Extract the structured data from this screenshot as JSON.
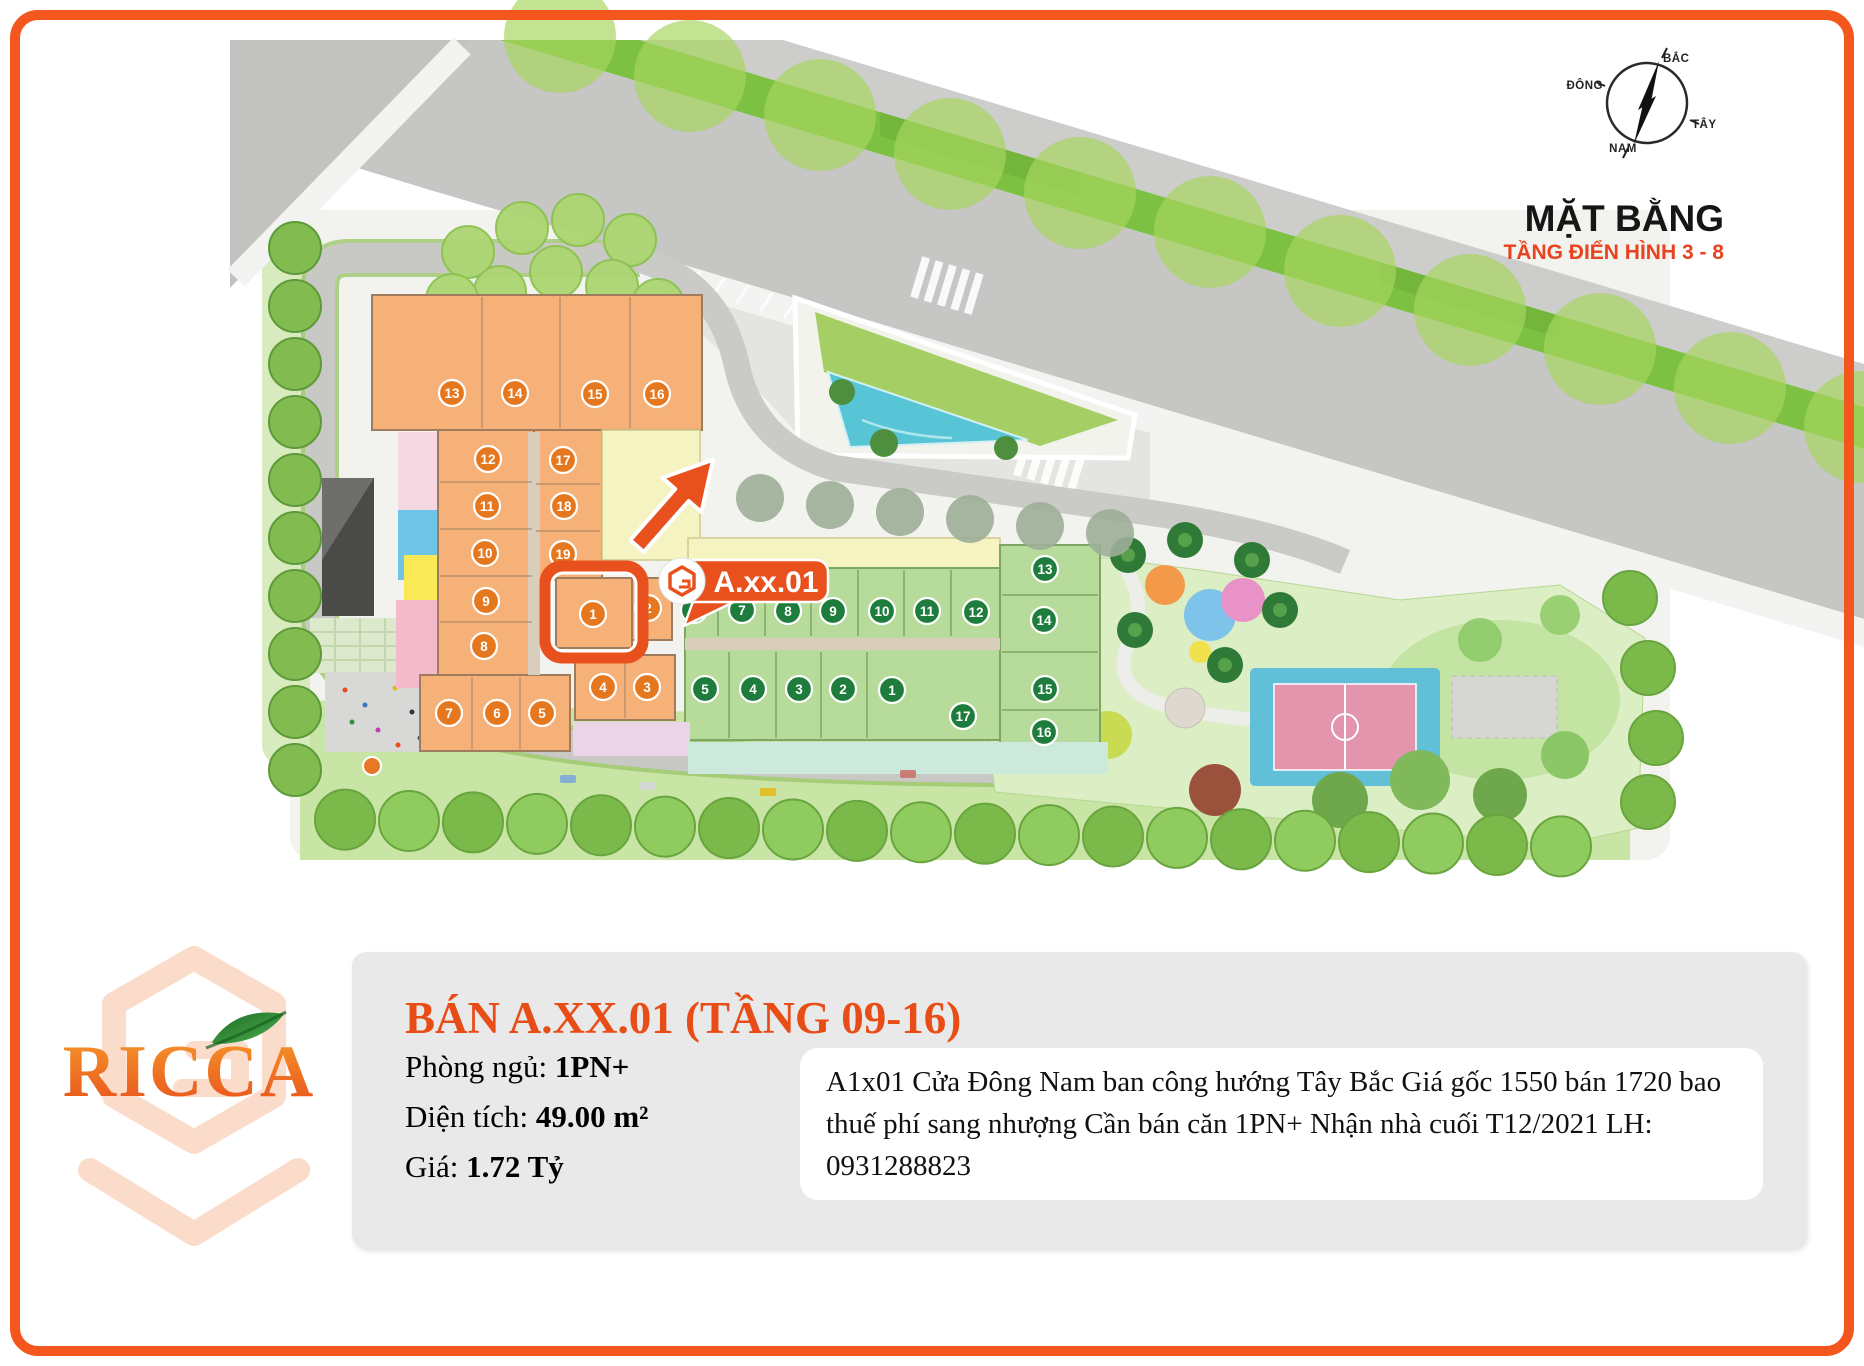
{
  "site_plan": {
    "heading": {
      "title": "MẶT BẰNG",
      "subtitle": "TẦNG ĐIỂN HÌNH 3 - 8"
    },
    "compass": {
      "north": "BẮC",
      "east": "ĐÔNG",
      "west": "TÂY",
      "south": "NAM"
    },
    "unit_label": {
      "text": "A.xx.01"
    },
    "highlighted_unit": "1",
    "blocks": {
      "orange_units": [
        {
          "n": "13",
          "x": 452,
          "y": 393
        },
        {
          "n": "14",
          "x": 515,
          "y": 393
        },
        {
          "n": "15",
          "x": 595,
          "y": 394
        },
        {
          "n": "16",
          "x": 657,
          "y": 394
        },
        {
          "n": "12",
          "x": 488,
          "y": 459
        },
        {
          "n": "17",
          "x": 563,
          "y": 460
        },
        {
          "n": "11",
          "x": 487,
          "y": 506
        },
        {
          "n": "18",
          "x": 564,
          "y": 506
        },
        {
          "n": "10",
          "x": 485,
          "y": 553
        },
        {
          "n": "19",
          "x": 563,
          "y": 554
        },
        {
          "n": "9",
          "x": 486,
          "y": 601
        },
        {
          "n": "8",
          "x": 484,
          "y": 646
        },
        {
          "n": "7",
          "x": 449,
          "y": 713
        },
        {
          "n": "6",
          "x": 497,
          "y": 713
        },
        {
          "n": "5",
          "x": 542,
          "y": 713
        },
        {
          "n": "4",
          "x": 603,
          "y": 687
        },
        {
          "n": "3",
          "x": 647,
          "y": 687
        },
        {
          "n": "2",
          "x": 648,
          "y": 608
        },
        {
          "n": "1",
          "x": 593,
          "y": 614
        }
      ],
      "green_units": [
        {
          "n": "6",
          "x": 694,
          "y": 610
        },
        {
          "n": "7",
          "x": 742,
          "y": 610
        },
        {
          "n": "8",
          "x": 788,
          "y": 611
        },
        {
          "n": "9",
          "x": 833,
          "y": 611
        },
        {
          "n": "10",
          "x": 882,
          "y": 611
        },
        {
          "n": "11",
          "x": 927,
          "y": 611
        },
        {
          "n": "12",
          "x": 976,
          "y": 612
        },
        {
          "n": "13",
          "x": 1045,
          "y": 569
        },
        {
          "n": "14",
          "x": 1044,
          "y": 620
        },
        {
          "n": "15",
          "x": 1045,
          "y": 689
        },
        {
          "n": "16",
          "x": 1044,
          "y": 732
        },
        {
          "n": "17",
          "x": 963,
          "y": 716
        },
        {
          "n": "5",
          "x": 705,
          "y": 689
        },
        {
          "n": "4",
          "x": 753,
          "y": 689
        },
        {
          "n": "3",
          "x": 799,
          "y": 689
        },
        {
          "n": "2",
          "x": 843,
          "y": 689
        },
        {
          "n": "1",
          "x": 892,
          "y": 690
        }
      ]
    }
  },
  "listing": {
    "title": "BÁN A.XX.01 (TẦNG 09-16)",
    "details": [
      {
        "label": "Phòng ngủ: ",
        "value": "1PN+"
      },
      {
        "label": "Diện tích: ",
        "value": "49.00 m²"
      },
      {
        "label": "Giá: ",
        "value": "1.72 Tỷ"
      }
    ],
    "description": "A1x01 Cửa Đông Nam ban công hướng Tây Bắc Giá gốc 1550 bán 1720 bao thuế phí sang nhượng Cần bán căn 1PN+ Nhận nhà cuối T12/2021 LH: 0931288823"
  },
  "logo": {
    "text": "RICCA"
  },
  "colors": {
    "accent_orange": "#E8511D",
    "frame_orange": "#F4571D",
    "unit_orange": "#E5771E",
    "unit_green": "#1E7C3C",
    "building_orange": "#F6B179",
    "building_green": "#B7DB9B",
    "median_green": "#7DC142",
    "pool_blue": "#58C5D6",
    "court_blue": "#62BFD8",
    "court_pink": "#E295AC"
  }
}
